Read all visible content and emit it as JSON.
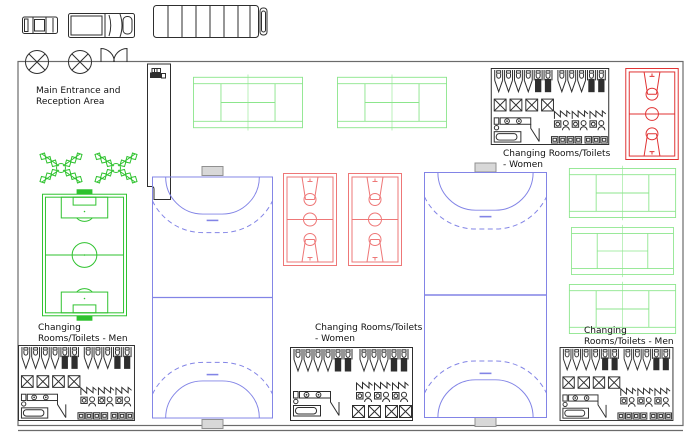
{
  "window": {
    "width": 685,
    "height": 435,
    "background": "#ffffff",
    "description": "Sports centre floor plan (CAD-style site layout)"
  },
  "labels": {
    "entrance": {
      "line1": "Main Entrance and",
      "line2": "Reception Area"
    },
    "women_top": {
      "line1": "Changing Rooms/Toilets",
      "line2": "- Women"
    },
    "men_bottom_left": {
      "line1": "Changing",
      "line2": "Rooms/Toilets - Men"
    },
    "women_bottom_mid": {
      "line1": "Changing Rooms/Toilets",
      "line2": "- Women"
    },
    "men_bottom_right": {
      "line1": "Changing",
      "line2": "Rooms/Toilets - Men"
    }
  },
  "colors": {
    "tennis": "#8ce68c",
    "pitch": "#2ec22e",
    "basketball": "#e03232",
    "basketball_mid": "#ee7777",
    "handball": "#8284e6",
    "goal_fill": "#d8d8d8",
    "goal_stroke": "#909090",
    "wall": "#6b6b6b",
    "fixture": "#2e2e2e",
    "text": "#111111"
  },
  "facilities": {
    "tennis_courts": 5,
    "basketball_courts": 3,
    "handball_courts": 2,
    "football_pitches": 1,
    "changing_rooms": 4,
    "trees": 2,
    "parked_vehicles": 3
  },
  "icons": [
    "car-icon",
    "van-icon",
    "bus-icon",
    "ceiling-light-icon",
    "double-door-icon",
    "reception-register-icon",
    "toilet-stall-icon",
    "shower-cubicle-icon",
    "wash-basin-icon",
    "bathtub-icon",
    "locker-icon",
    "tree-icon",
    "tennis-court-icon",
    "basketball-court-icon",
    "handball-court-icon",
    "football-pitch-icon",
    "handball-goal-icon"
  ]
}
